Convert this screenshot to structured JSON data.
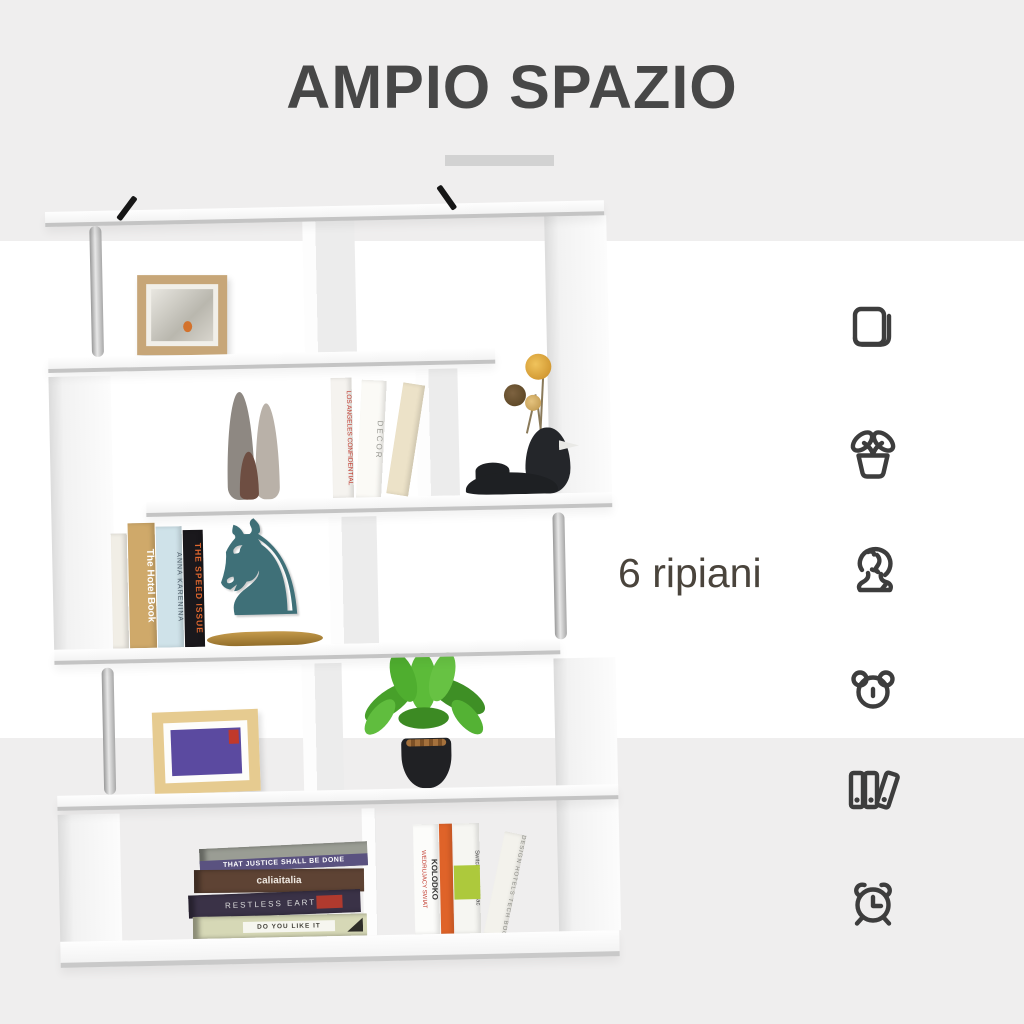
{
  "header": {
    "title": "AMPIO SPAZIO"
  },
  "callout": {
    "text": "6 ripiani"
  },
  "feature_icons": [
    {
      "id": "book-icon",
      "meaning": "book"
    },
    {
      "id": "plant-icon",
      "meaning": "potted plant"
    },
    {
      "id": "statue-icon",
      "meaning": "statue bust"
    },
    {
      "id": "bear-icon",
      "meaning": "teddy bear"
    },
    {
      "id": "binders-icon",
      "meaning": "ring binders"
    },
    {
      "id": "alarm-clock-icon",
      "meaning": "alarm clock"
    }
  ],
  "shelf": {
    "description": "white S-shaped 6-shelf bookcase with silver poles and decor",
    "book_spines": {
      "los_angeles": "LOS ANGELES CONFIDENTIAL",
      "decor": "DECOR",
      "hotel_book": "The Hotel Book",
      "anna_karenina": "ANNA KARENINA",
      "speed_issue": "THE SPEED ISSUE",
      "justice": "THAT JUSTICE SHALL BE DONE",
      "calia": "caliaitalia",
      "restless": "RESTLESS EARTH",
      "do_you_like": "DO YOU LIKE IT",
      "kolodko_title": "WEDRUJACY SWIAT",
      "kolodko_author": "KOLODKO",
      "switching_mac": "Switching to the Mac",
      "design_hotels": "DESIGN HOTELS TECH BOOKS"
    },
    "horse_glyph": "♞"
  },
  "colors": {
    "band_gray": "#efeeee",
    "band_white": "#ffffff",
    "title_text": "#474747",
    "callout_text": "#4a443c",
    "divider": "#d2d2d2",
    "icon_stroke": "#3d3d3d",
    "shelf_white": "#fbfbfb",
    "shelf_edge": "#c4c4c4",
    "pole_silver": "#b5b5b5",
    "horse_teal": "#3f7078",
    "horse_base_gold": "#b08d3e",
    "plant_green": "#4ea82e",
    "frame_wood": "#c7a678",
    "frame_wood_light": "#e6cb90",
    "image_purple": "#5b4aa0",
    "penguin_black": "#24262a"
  }
}
